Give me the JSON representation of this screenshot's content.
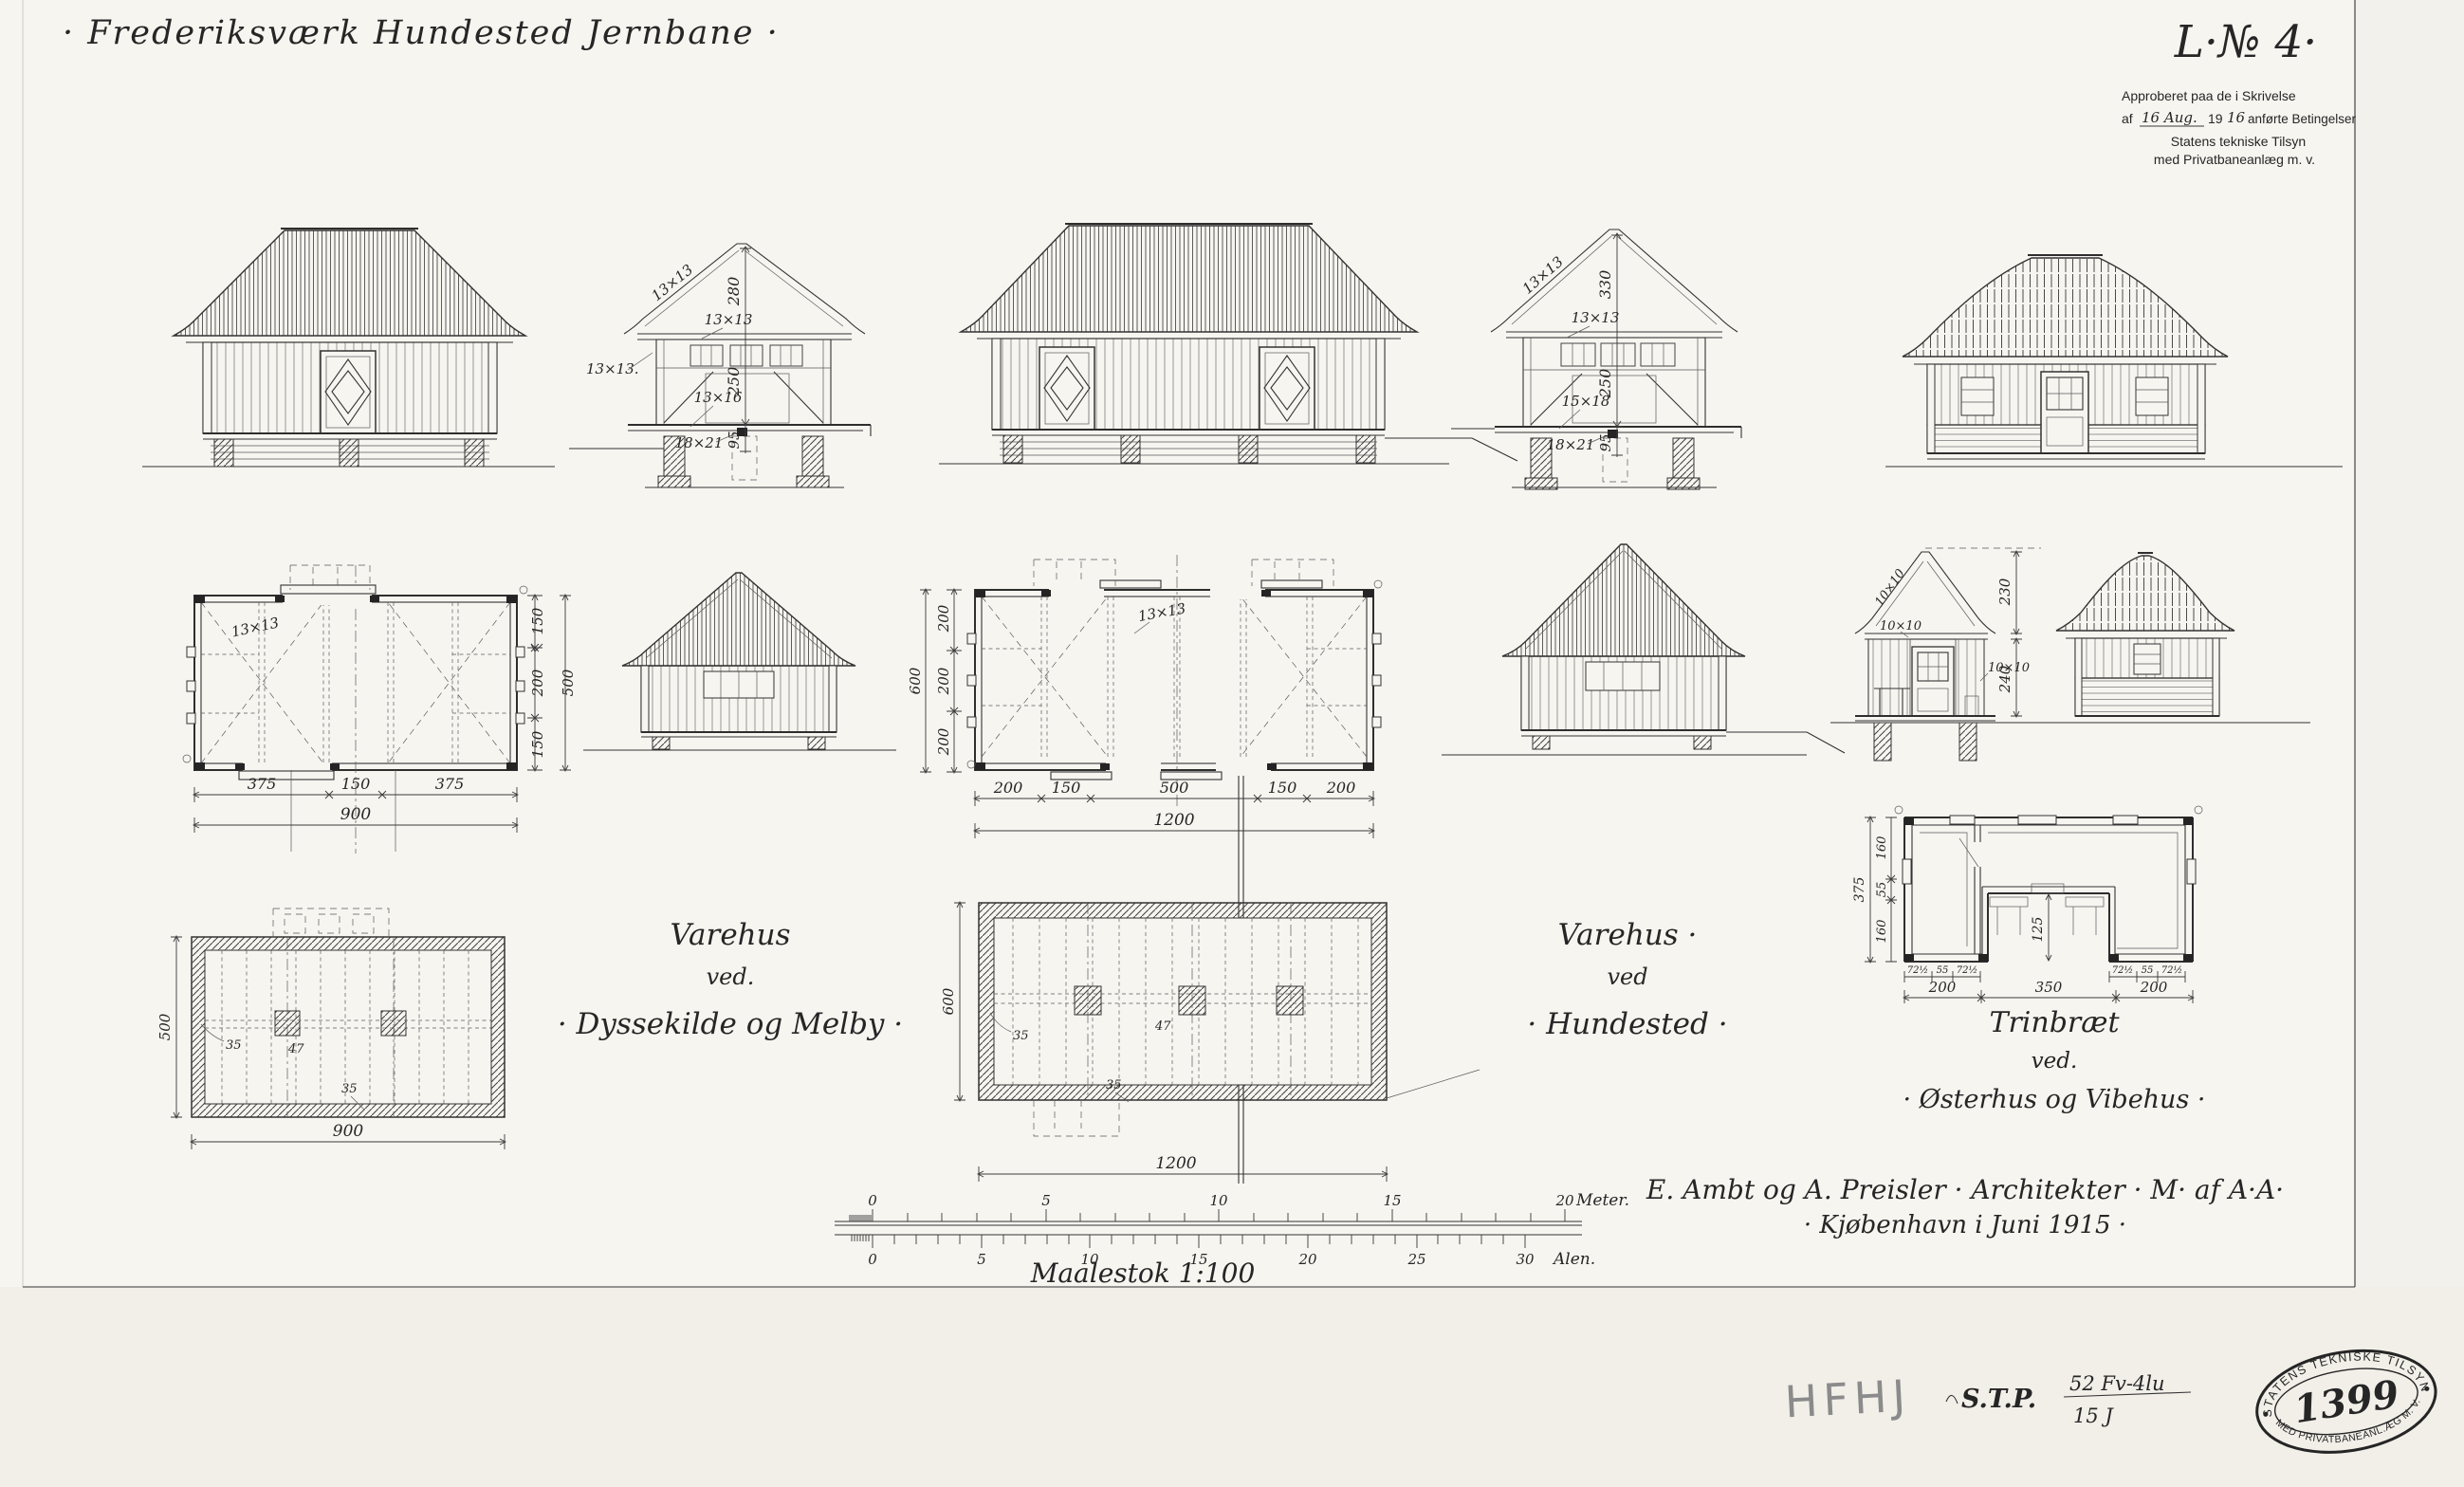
{
  "sheet": {
    "title": "· Frederiksværk Hundested Jernbane ·",
    "drawing_no": "L·№ 4·",
    "approval": {
      "line1": "Approberet paa de i Skrivelse",
      "af": "af",
      "date": "16 Aug.",
      "year_print": "19",
      "year_hand": "16",
      "line2_rest": "anførte Betingelser",
      "line3": "Statens tekniske Tilsyn",
      "line4": "med Privatbaneanlæg m. v."
    },
    "signature": [
      "E. Ambt og A. Preisler · Architekter · M· af A·A·",
      "· Kjøbenhavn i Juni 1915 ·"
    ]
  },
  "captions": {
    "melby": [
      "Varehus",
      "ved.",
      "· Dyssekilde og Melby ·"
    ],
    "hundested": [
      "Varehus ·",
      "ved",
      "· Hundested ·"
    ],
    "trinbraet": [
      "Trinbræt",
      "ved.",
      "· Østerhus og Vibehus ·"
    ]
  },
  "section_melby": {
    "dims": [
      "280",
      "250",
      "95"
    ],
    "timber_roof": "13×13",
    "timber_plate": "13×13",
    "timber_left": "13×13.",
    "timber_sill": "13×16",
    "timber_post": "18×21"
  },
  "section_hundested": {
    "dims": [
      "330",
      "250",
      "95"
    ],
    "timber_roof": "13×13",
    "timber_plate": "13×13",
    "timber_sill": "15×18",
    "timber_post": "18×21"
  },
  "section_trinbraet": {
    "dims": [
      "230",
      "240"
    ],
    "timber_roof": "10×10",
    "timber_plate": "10×10",
    "timber_wall": "10×10"
  },
  "plan_melby": {
    "timber": "13×13",
    "dims_bottom": [
      "375",
      "150",
      "375"
    ],
    "total_bottom": "900",
    "dims_right": [
      "150",
      "200",
      "150"
    ],
    "total_right": "500"
  },
  "plan_hundested": {
    "timber": "13×13",
    "dims_bottom": [
      "200",
      "150",
      "500",
      "150",
      "200"
    ],
    "total_bottom": "1200",
    "dims_left": [
      "200",
      "200",
      "200"
    ],
    "total_left": "600"
  },
  "foundation_melby": {
    "dim_left": "500",
    "dim_bottom": "900",
    "notes": [
      "35",
      "47",
      "35"
    ]
  },
  "foundation_hundested": {
    "dim_left": "600",
    "dim_bottom": "1200",
    "notes": [
      "35",
      "47",
      "35"
    ]
  },
  "plan_trinbraet": {
    "total_left": "375",
    "dims_left": [
      "160",
      "55",
      "160"
    ],
    "dims_small_left": [
      "72½",
      "55",
      "72½"
    ],
    "dims_small_right": [
      "72½",
      "55",
      "72½"
    ],
    "dims_bottom": [
      "200",
      "350",
      "200"
    ],
    "dim_inner": "125"
  },
  "scale_bar": {
    "caption": "Maalestok 1:100",
    "meter_labels": [
      "0",
      "5",
      "10",
      "15",
      "20"
    ],
    "meter_unit": "Meter.",
    "alen_labels": [
      "0",
      "5",
      "10",
      "15",
      "20",
      "25",
      "30"
    ],
    "alen_unit": "Alen."
  },
  "annotations": {
    "hfhj": "HFHJ",
    "stp_prefix": "S.T.P.",
    "stp_top": "52 Fv-4lu",
    "stp_bottom": "15     J"
  },
  "stamp": {
    "top": "STATENS TEKNISKE TILSYN",
    "number": "1399",
    "bottom": "MED PRIVATBANEANL.ÆG M. V."
  }
}
